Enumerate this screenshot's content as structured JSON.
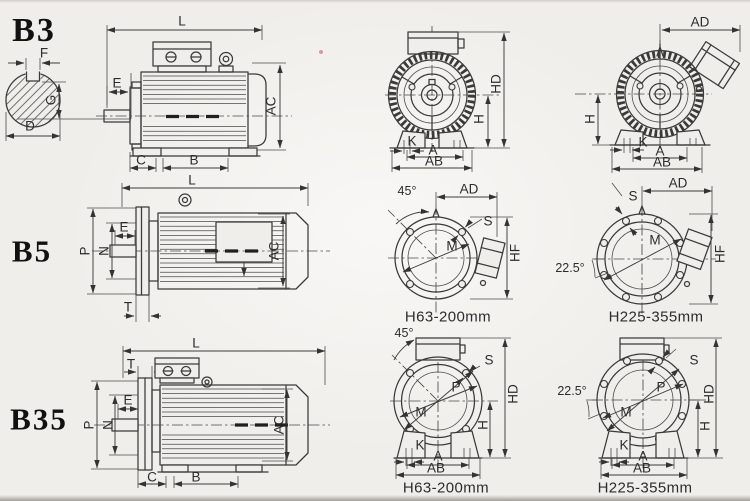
{
  "colors": {
    "line": "#3a3a3a",
    "paper": "#f0eeea",
    "text": "#2c2c2c"
  },
  "labels": {
    "b3_code": "B3",
    "b5_code": "B5",
    "b35_code": "B35",
    "shaft_f": "F",
    "shaft_g": "G",
    "shaft_d": "D",
    "b3_l": "L",
    "b3_e": "E",
    "b3_ac": "AC",
    "b3_c": "C",
    "b3_b": "B",
    "b3f_hd": "HD",
    "b3f_h": "H",
    "b3f_k": "K",
    "b3f_a": "A",
    "b3f_ab": "AB",
    "b3r_ad": "AD",
    "b3r_h": "H",
    "b3r_k": "K",
    "b3r_a": "A",
    "b3r_ab": "AB",
    "b5_l": "L",
    "b5_p": "P",
    "b5_n": "N",
    "b5_e": "E",
    "b5_t": "T",
    "b5_ac": "AC",
    "b5m_deg": "45°",
    "b5m_ad": "AD",
    "b5m_s": "S",
    "b5m_m": "M",
    "b5m_hf": "HF",
    "b5m_cap": "H63-200mm",
    "b5r_ad": "AD",
    "b5r_s": "S",
    "b5r_m": "M",
    "b5r_deg": "22.5°",
    "b5r_hf": "HF",
    "b5r_cap": "H225-355mm",
    "b35_l": "L",
    "b35_t": "T",
    "b35_p": "P",
    "b35_n": "N",
    "b35_e": "E",
    "b35_c": "C",
    "b35_b": "B",
    "b35_ac": "AC",
    "b35m_deg": "45°",
    "b35m_s": "S",
    "b35m_p": "P",
    "b35m_m": "M",
    "b35m_h": "H",
    "b35m_hd": "HD",
    "b35m_k": "K",
    "b35m_a": "A",
    "b35m_ab": "AB",
    "b35m_cap": "H63-200mm",
    "b35r_deg": "22.5°",
    "b35r_s": "S",
    "b35r_p": "P",
    "b35r_m": "M",
    "b35r_h": "H",
    "b35r_hd": "HD",
    "b35r_k": "K",
    "b35r_a": "A",
    "b35r_ab": "AB",
    "b35r_cap": "H225-355mm"
  }
}
